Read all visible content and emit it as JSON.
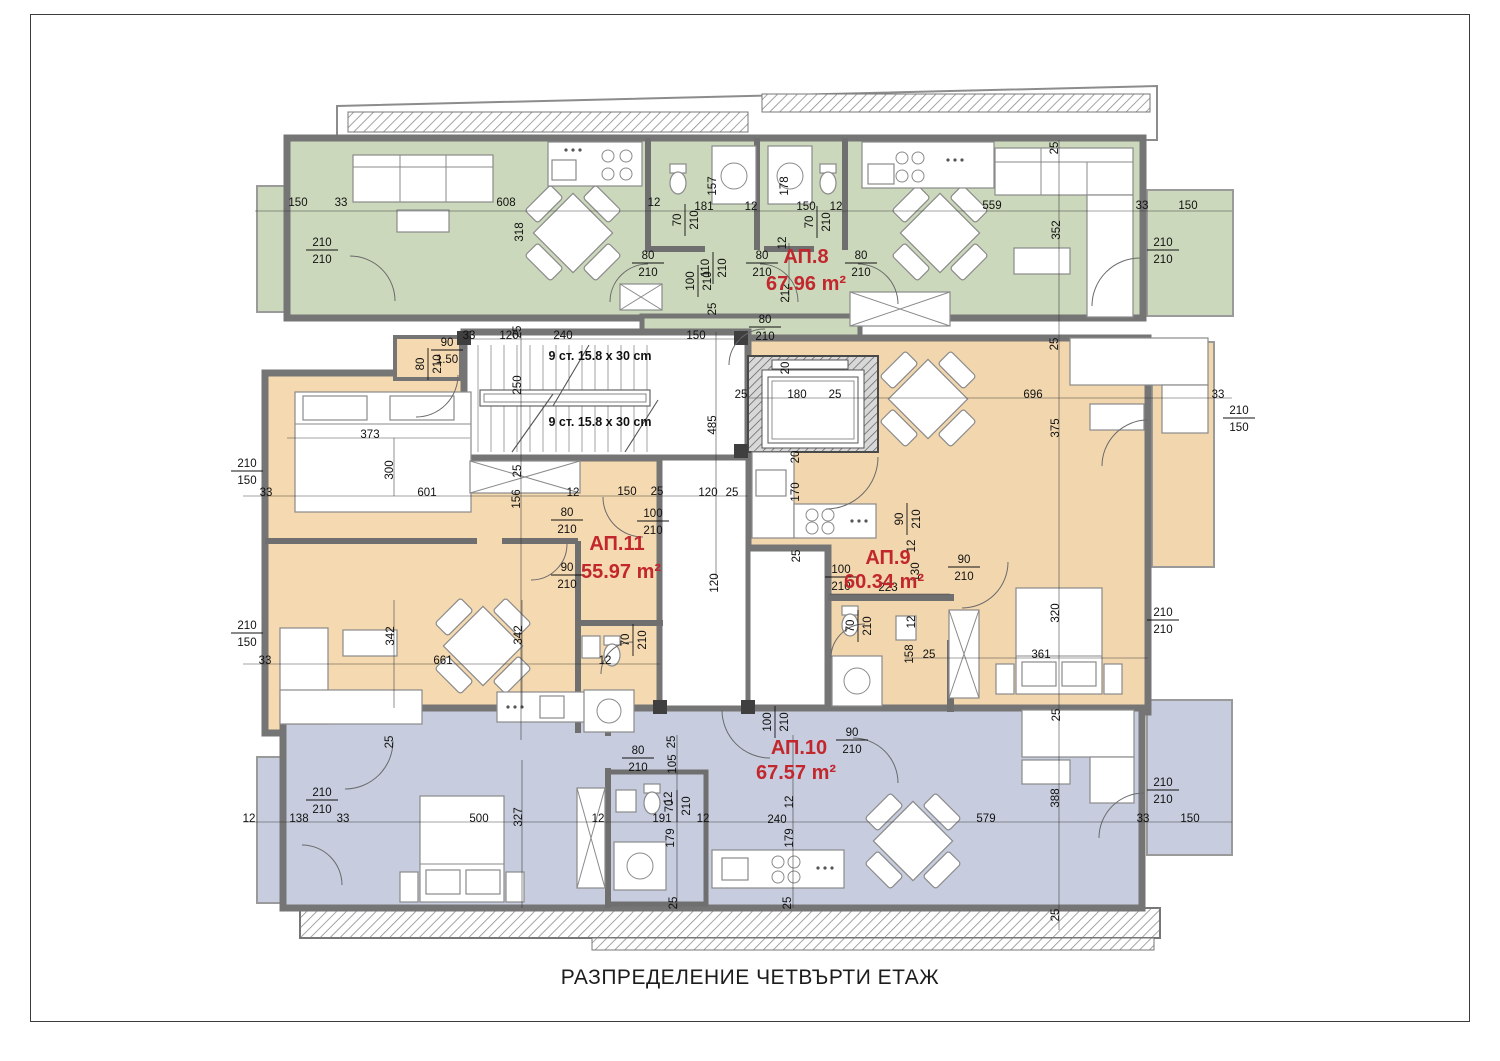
{
  "page": {
    "title": "РАЗПРЕДЕЛЕНИЕ ЧЕТВЪРТИ ЕТАЖ"
  },
  "colors": {
    "apartment_green": "#ccd8bc",
    "apartment_orange": "#f5d9b0",
    "apartment_blue": "#c7cdde",
    "wall_gray": "#757575",
    "label_red": "#c1272d",
    "dimension_text": "#111111"
  },
  "apartments": [
    {
      "name": "АП.8",
      "area": "67.96 m²",
      "x": 806,
      "y": 263,
      "ax": 806,
      "ay": 290
    },
    {
      "name": "АП.9",
      "area": "60.34 m²",
      "x": 888,
      "y": 564,
      "ax": 884,
      "ay": 588
    },
    {
      "name": "АП.10",
      "area": "67.57 m²",
      "x": 799,
      "y": 754,
      "ax": 796,
      "ay": 779
    },
    {
      "name": "АП.11",
      "area": "55.97 m²",
      "x": 617,
      "y": 550,
      "ax": 621,
      "ay": 578
    }
  ],
  "stairs": [
    {
      "text": "9 ст. 15.8 x 30 cm",
      "x": 600,
      "y": 360
    },
    {
      "text": "9 ст. 15.8 x 30 cm",
      "x": 600,
      "y": 426
    }
  ],
  "labels": [
    {
      "t": "150",
      "x": 298,
      "y": 206
    },
    {
      "t": "33",
      "x": 341,
      "y": 206
    },
    {
      "t": "608",
      "x": 506,
      "y": 206
    },
    {
      "t": "318",
      "x": 523,
      "y": 232,
      "r": 1
    },
    {
      "t": [
        "210",
        "210"
      ],
      "x": 322,
      "y": 250
    },
    {
      "t": "12",
      "x": 654,
      "y": 206
    },
    {
      "t": "157",
      "x": 716,
      "y": 186,
      "r": 1
    },
    {
      "t": "181",
      "x": 704,
      "y": 210
    },
    {
      "t": "12",
      "x": 751,
      "y": 210
    },
    {
      "t": "178",
      "x": 788,
      "y": 186,
      "r": 1
    },
    {
      "t": "150",
      "x": 806,
      "y": 210
    },
    {
      "t": "12",
      "x": 836,
      "y": 210
    },
    {
      "t": [
        "70",
        "210"
      ],
      "x": 685,
      "y": 220,
      "r": 1
    },
    {
      "t": [
        "70",
        "210"
      ],
      "x": 817,
      "y": 222,
      "r": 1
    },
    {
      "t": [
        "80",
        "210"
      ],
      "x": 648,
      "y": 263
    },
    {
      "t": [
        "80",
        "210"
      ],
      "x": 762,
      "y": 263
    },
    {
      "t": [
        "80",
        "210"
      ],
      "x": 861,
      "y": 263
    },
    {
      "t": [
        "110",
        "210"
      ],
      "x": 713,
      "y": 268,
      "r": 1
    },
    {
      "t": [
        "100",
        "210"
      ],
      "x": 698,
      "y": 281,
      "r": 1
    },
    {
      "t": "212",
      "x": 789,
      "y": 293,
      "r": 1
    },
    {
      "t": "12",
      "x": 786,
      "y": 243,
      "r": 1
    },
    {
      "t": "559",
      "x": 992,
      "y": 209
    },
    {
      "t": "352",
      "x": 1060,
      "y": 230,
      "r": 1
    },
    {
      "t": "33",
      "x": 1142,
      "y": 209
    },
    {
      "t": "150",
      "x": 1188,
      "y": 209
    },
    {
      "t": [
        "210",
        "210"
      ],
      "x": 1163,
      "y": 250
    },
    {
      "t": "25",
      "x": 1058,
      "y": 148,
      "r": 1
    },
    {
      "t": "120",
      "x": 509,
      "y": 339
    },
    {
      "t": "240",
      "x": 563,
      "y": 339
    },
    {
      "t": "150",
      "x": 696,
      "y": 339
    },
    {
      "t": "250",
      "x": 521,
      "y": 385,
      "r": 1
    },
    {
      "t": "485",
      "x": 716,
      "y": 425,
      "r": 1
    },
    {
      "t": "180",
      "x": 797,
      "y": 398
    },
    {
      "t": "25",
      "x": 741,
      "y": 398
    },
    {
      "t": "25",
      "x": 835,
      "y": 398
    },
    {
      "t": "20",
      "x": 789,
      "y": 368,
      "r": 1
    },
    {
      "t": [
        "80",
        "210"
      ],
      "x": 765,
      "y": 327
    },
    {
      "t": "25",
      "x": 716,
      "y": 309,
      "r": 1
    },
    {
      "t": "373",
      "x": 370,
      "y": 438
    },
    {
      "t": "300",
      "x": 393,
      "y": 470,
      "r": 1
    },
    {
      "t": [
        "210",
        "150"
      ],
      "x": 247,
      "y": 471
    },
    {
      "t": "33",
      "x": 266,
      "y": 496
    },
    {
      "t": "601",
      "x": 427,
      "y": 496
    },
    {
      "t": "25",
      "x": 521,
      "y": 471,
      "r": 1
    },
    {
      "t": "156",
      "x": 520,
      "y": 499,
      "r": 1
    },
    {
      "t": "12",
      "x": 573,
      "y": 496
    },
    {
      "t": [
        "80",
        "210"
      ],
      "x": 567,
      "y": 520
    },
    {
      "t": [
        "90",
        "210"
      ],
      "x": 567,
      "y": 575
    },
    {
      "t": "150",
      "x": 627,
      "y": 495
    },
    {
      "t": "25",
      "x": 657,
      "y": 495
    },
    {
      "t": [
        "100",
        "210"
      ],
      "x": 653,
      "y": 521
    },
    {
      "t": "120",
      "x": 708,
      "y": 496
    },
    {
      "t": "25",
      "x": 732,
      "y": 496
    },
    {
      "t": "120",
      "x": 718,
      "y": 583,
      "r": 1
    },
    {
      "t": "342",
      "x": 394,
      "y": 636,
      "r": 1
    },
    {
      "t": "342",
      "x": 522,
      "y": 635,
      "r": 1
    },
    {
      "t": "661",
      "x": 443,
      "y": 664
    },
    {
      "t": "33",
      "x": 265,
      "y": 664
    },
    {
      "t": [
        "70",
        "210"
      ],
      "x": 633,
      "y": 640,
      "r": 1
    },
    {
      "t": "12",
      "x": 605,
      "y": 664
    },
    {
      "t": "25",
      "x": 393,
      "y": 742,
      "r": 1
    },
    {
      "t": [
        "210",
        "150"
      ],
      "x": 247,
      "y": 633
    },
    {
      "t": [
        "90",
        "1.50"
      ],
      "x": 447,
      "y": 350
    },
    {
      "t": [
        "80",
        "210"
      ],
      "x": 428,
      "y": 364,
      "r": 1
    },
    {
      "t": "33",
      "x": 469,
      "y": 339
    },
    {
      "t": "25",
      "x": 521,
      "y": 332,
      "r": 1
    },
    {
      "t": "20",
      "x": 799,
      "y": 457,
      "r": 1
    },
    {
      "t": "170",
      "x": 799,
      "y": 492,
      "r": 1
    },
    {
      "t": "25",
      "x": 800,
      "y": 556,
      "r": 1
    },
    {
      "t": [
        "100",
        "210"
      ],
      "x": 841,
      "y": 577
    },
    {
      "t": "223",
      "x": 888,
      "y": 591
    },
    {
      "t": "130",
      "x": 919,
      "y": 572,
      "r": 1
    },
    {
      "t": "12",
      "x": 915,
      "y": 546,
      "r": 1
    },
    {
      "t": [
        "90",
        "210"
      ],
      "x": 964,
      "y": 567
    },
    {
      "t": [
        "70",
        "210"
      ],
      "x": 858,
      "y": 626,
      "r": 1
    },
    {
      "t": "12",
      "x": 915,
      "y": 622,
      "r": 1
    },
    {
      "t": "158",
      "x": 913,
      "y": 654,
      "r": 1
    },
    {
      "t": "25",
      "x": 929,
      "y": 658
    },
    {
      "t": "320",
      "x": 1059,
      "y": 613,
      "r": 1
    },
    {
      "t": "361",
      "x": 1041,
      "y": 658
    },
    {
      "t": [
        "210",
        "210"
      ],
      "x": 1163,
      "y": 620
    },
    {
      "t": "696",
      "x": 1033,
      "y": 398
    },
    {
      "t": "25",
      "x": 1058,
      "y": 344,
      "r": 1
    },
    {
      "t": "375",
      "x": 1059,
      "y": 428,
      "r": 1
    },
    {
      "t": "33",
      "x": 1218,
      "y": 398
    },
    {
      "t": [
        "210",
        "150"
      ],
      "x": 1239,
      "y": 418
    },
    {
      "t": [
        "90",
        "210"
      ],
      "x": 907,
      "y": 519,
      "r": 1
    },
    {
      "t": [
        "100",
        "210"
      ],
      "x": 775,
      "y": 722,
      "r": 1
    },
    {
      "t": [
        "90",
        "210"
      ],
      "x": 852,
      "y": 740
    },
    {
      "t": "12",
      "x": 793,
      "y": 802,
      "r": 1
    },
    {
      "t": "240",
      "x": 777,
      "y": 823
    },
    {
      "t": "191",
      "x": 662,
      "y": 822
    },
    {
      "t": "12",
      "x": 703,
      "y": 822
    },
    {
      "t": "579",
      "x": 986,
      "y": 822
    },
    {
      "t": [
        "70",
        "210"
      ],
      "x": 677,
      "y": 806,
      "r": 1
    },
    {
      "t": "179",
      "x": 674,
      "y": 838,
      "r": 1
    },
    {
      "t": "179",
      "x": 793,
      "y": 838,
      "r": 1
    },
    {
      "t": "25",
      "x": 677,
      "y": 903,
      "r": 1
    },
    {
      "t": "25",
      "x": 791,
      "y": 903,
      "r": 1
    },
    {
      "t": "12",
      "x": 672,
      "y": 798,
      "r": 1
    },
    {
      "t": [
        "210",
        "210"
      ],
      "x": 322,
      "y": 800
    },
    {
      "t": "12",
      "x": 249,
      "y": 822
    },
    {
      "t": "138",
      "x": 299,
      "y": 822
    },
    {
      "t": "33",
      "x": 343,
      "y": 822
    },
    {
      "t": "500",
      "x": 479,
      "y": 822
    },
    {
      "t": "327",
      "x": 522,
      "y": 817,
      "r": 1
    },
    {
      "t": "12",
      "x": 598,
      "y": 822
    },
    {
      "t": [
        "80",
        "210"
      ],
      "x": 638,
      "y": 758
    },
    {
      "t": "25",
      "x": 675,
      "y": 742,
      "r": 1
    },
    {
      "t": "105",
      "x": 676,
      "y": 764,
      "r": 1
    },
    {
      "t": "25",
      "x": 1060,
      "y": 715,
      "r": 1
    },
    {
      "t": "388",
      "x": 1059,
      "y": 798,
      "r": 1
    },
    {
      "t": [
        "210",
        "210"
      ],
      "x": 1163,
      "y": 790
    },
    {
      "t": "33",
      "x": 1143,
      "y": 822
    },
    {
      "t": "150",
      "x": 1190,
      "y": 822
    },
    {
      "t": "25",
      "x": 1059,
      "y": 915,
      "r": 1
    }
  ]
}
